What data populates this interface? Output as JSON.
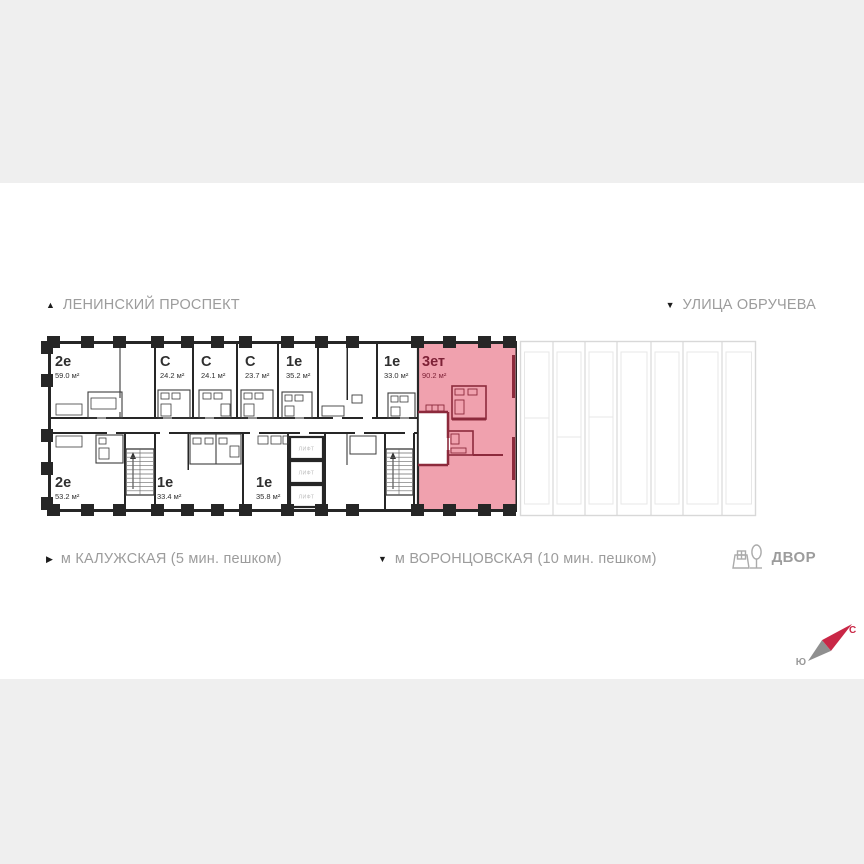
{
  "streets": {
    "lenin": "ЛЕНИНСКИЙ ПРОСПЕКТ",
    "obrucheva": "УЛИЦА ОБРУЧЕВА"
  },
  "transit": {
    "kaluzhskaya": "м КАЛУЖСКАЯ (5 мин. пешком)",
    "vorontsovskaya": "м ВОРОНЦОВСКАЯ  (10 мин. пешком)",
    "yard": "ДВОР"
  },
  "icons": {
    "up_triangle": "▲",
    "down_triangle": "▼",
    "right_triangle": "▶"
  },
  "compass": {
    "north": "С",
    "south": "Ю"
  },
  "core": {
    "elevator_label": "ЛИФТ"
  },
  "units": {
    "top_row": [
      {
        "type": "2е",
        "area": "59.0 м²"
      },
      {
        "type": "С",
        "area": "24.2 м²"
      },
      {
        "type": "С",
        "area": "24.1 м²"
      },
      {
        "type": "С",
        "area": "23.7 м²"
      },
      {
        "type": "1е",
        "area": "35.2 м²"
      },
      {
        "type": "1е",
        "area": "33.0 м²"
      },
      {
        "type": "3ет",
        "area": "90.2 м²",
        "selected": true
      }
    ],
    "bottom_row": [
      {
        "type": "2е",
        "area": "53.2 м²"
      },
      {
        "type": "1е",
        "area": "33.4 м²"
      },
      {
        "type": "1е",
        "area": "35.8 м²"
      }
    ]
  },
  "colors": {
    "page_bg": "#efefef",
    "card_bg": "#ffffff",
    "wall": "#262626",
    "muted_text": "#9c9c9c",
    "selected_fill": "#f0a1ae",
    "selected_wall": "#8c2a3c",
    "selected_text": "#7d2136",
    "north_red": "#c92746",
    "faded_line": "#d8d8d8"
  }
}
